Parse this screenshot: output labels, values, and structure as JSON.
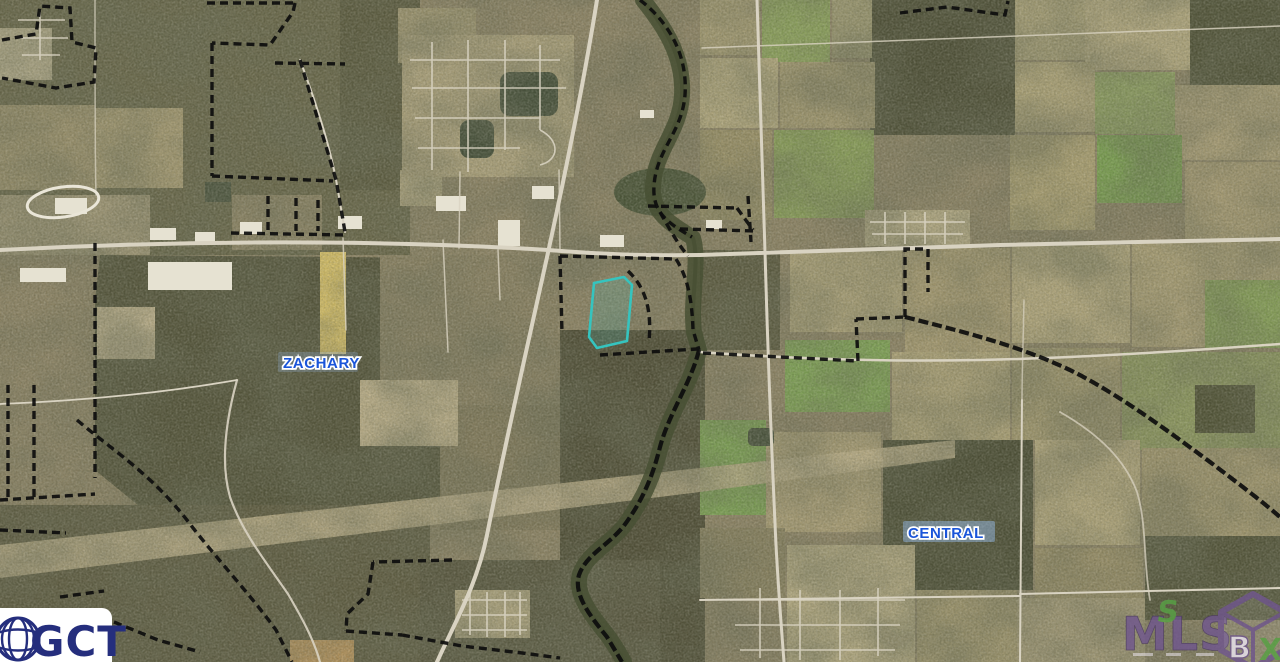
{
  "map": {
    "labels": {
      "zachary": "ZACHARY",
      "central": "CENTRAL"
    }
  },
  "watermarks": {
    "gct": {
      "text": "GCT"
    },
    "mls": {
      "text": "MLS",
      "box_letters": {
        "top": "S",
        "left": "B",
        "right": "X"
      }
    }
  },
  "colors": {
    "label-blue": "#1a55d9",
    "label-halo": "#ffffff",
    "parcel-cyan": "#35c4bf",
    "boundary-black": "#0d0d0d",
    "gct-navy": "#252e7d",
    "mls-purple": "#70568f",
    "mls-green": "#58a345"
  }
}
